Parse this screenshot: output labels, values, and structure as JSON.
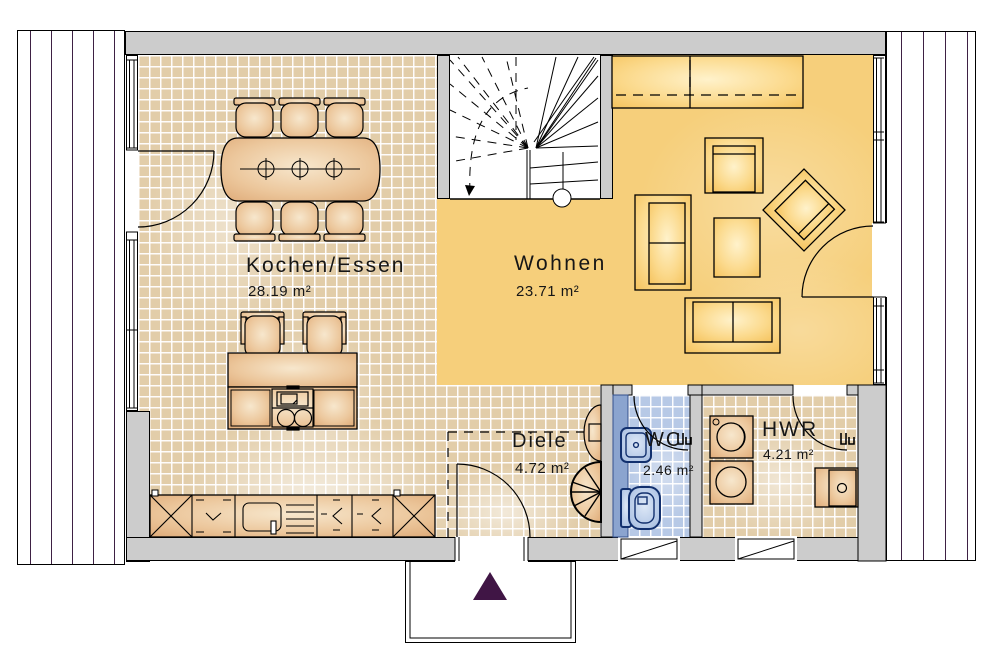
{
  "rooms": {
    "kochen": {
      "label": "Kochen/Essen",
      "area": "28.19 m²"
    },
    "wohnen": {
      "label": "Wohnen",
      "area": "23.71 m²"
    },
    "diele": {
      "label": "Diele",
      "area": "4.72 m²"
    },
    "wc": {
      "label": "WC",
      "area": "2.46 m²"
    },
    "hwr": {
      "label": "HWR",
      "area": "4.21 m²"
    }
  },
  "colors": {
    "wall_gray": "#cccccc",
    "kitchen_tile": "#e2cda9",
    "living_floor": "#f6cf7b",
    "wc_tile": "#b7c9e6",
    "wc_install_wall": "#8ba4cf",
    "wood_furniture": "#dfae7d",
    "living_furniture": "#f8c966",
    "fixture_blue": "#9db5da",
    "deck_plank_line": "#3e2144",
    "entrance_arrow": "#401545",
    "outline": "#000000"
  },
  "icons": [
    "dining-table",
    "dining-chair",
    "bar-stool",
    "kitchen-island",
    "cooktop",
    "oven",
    "kitchen-counter",
    "kitchen-sink",
    "corner-cabinet",
    "sideboard",
    "armchair",
    "rotated-armchair",
    "sofa",
    "coffee-table",
    "staircase",
    "washbasin",
    "toilet",
    "washing-machine",
    "dryer",
    "utility-sink",
    "console-table",
    "coat-rack",
    "terrace-planks",
    "entrance-arrow",
    "door-swing",
    "window"
  ]
}
